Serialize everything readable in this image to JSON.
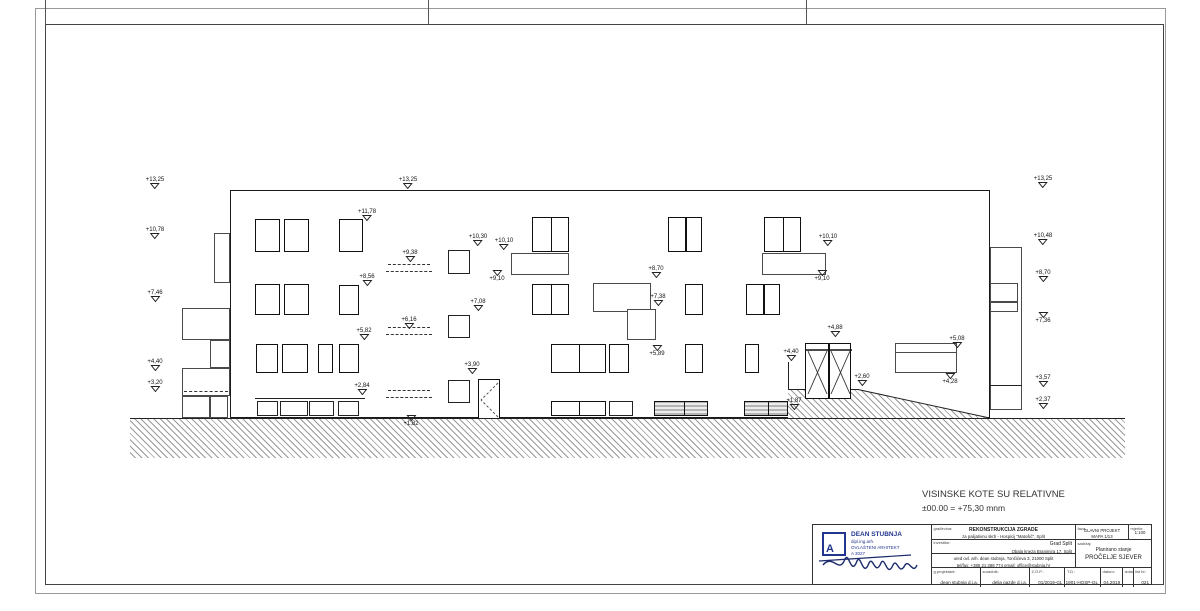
{
  "notes": {
    "line1": "VISINSKE KOTE SU RELATIVNE",
    "line2": "±00.00 = +75,30 mnm"
  },
  "drawing": {
    "elevation_markers": [
      {
        "label": "+13,25",
        "x": 155,
        "y": 190
      },
      {
        "label": "+10,78",
        "x": 155,
        "y": 240
      },
      {
        "label": "+7,46",
        "x": 155,
        "y": 303
      },
      {
        "label": "+4,40",
        "x": 155,
        "y": 372
      },
      {
        "label": "+3,20",
        "x": 155,
        "y": 393
      },
      {
        "label": "+13,25",
        "x": 408,
        "y": 190
      },
      {
        "label": "+11,78",
        "x": 367,
        "y": 222
      },
      {
        "label": "+10,30",
        "x": 478,
        "y": 247
      },
      {
        "label": "+10,10",
        "x": 504,
        "y": 251
      },
      {
        "label": "+9,38",
        "x": 410,
        "y": 263
      },
      {
        "label": "+9,10",
        "x": 497,
        "y": 271,
        "below": true
      },
      {
        "label": "+8,56",
        "x": 367,
        "y": 287
      },
      {
        "label": "+8,70",
        "x": 656,
        "y": 279
      },
      {
        "label": "+7,38",
        "x": 658,
        "y": 307
      },
      {
        "label": "+7,08",
        "x": 478,
        "y": 312
      },
      {
        "label": "+6,16",
        "x": 409,
        "y": 330
      },
      {
        "label": "+5,82",
        "x": 364,
        "y": 341
      },
      {
        "label": "+5,89",
        "x": 657,
        "y": 346,
        "below": true
      },
      {
        "label": "+3,90",
        "x": 472,
        "y": 375
      },
      {
        "label": "+2,84",
        "x": 362,
        "y": 396
      },
      {
        "label": "+1,82",
        "x": 411,
        "y": 416,
        "below": true
      },
      {
        "label": "+4,40",
        "x": 791,
        "y": 362
      },
      {
        "label": "+4,88",
        "x": 835,
        "y": 338
      },
      {
        "label": "+2,60",
        "x": 862,
        "y": 387
      },
      {
        "label": "+1,87",
        "x": 794,
        "y": 411
      },
      {
        "label": "+5,08",
        "x": 957,
        "y": 349
      },
      {
        "label": "+4,28",
        "x": 950,
        "y": 374,
        "below": true
      },
      {
        "label": "+10,10",
        "x": 828,
        "y": 247
      },
      {
        "label": "+9,10",
        "x": 822,
        "y": 271,
        "below": true
      },
      {
        "label": "+13,25",
        "x": 1043,
        "y": 189
      },
      {
        "label": "+10,48",
        "x": 1043,
        "y": 246
      },
      {
        "label": "+8,70",
        "x": 1043,
        "y": 283
      },
      {
        "label": "+7,36",
        "x": 1043,
        "y": 313,
        "below": true
      },
      {
        "label": "+3,57",
        "x": 1043,
        "y": 388
      },
      {
        "label": "+2,37",
        "x": 1043,
        "y": 410
      }
    ],
    "rects": [
      {
        "x": 255,
        "y": 219,
        "w": 25,
        "h": 33,
        "cls": "win"
      },
      {
        "x": 284,
        "y": 219,
        "w": 25,
        "h": 33,
        "cls": "win"
      },
      {
        "x": 339,
        "y": 219,
        "w": 24,
        "h": 33,
        "cls": "win"
      },
      {
        "x": 532,
        "y": 217,
        "w": 37,
        "h": 35,
        "cls": "win2"
      },
      {
        "x": 668,
        "y": 217,
        "w": 34,
        "h": 35,
        "cls": "win2"
      },
      {
        "x": 764,
        "y": 217,
        "w": 37,
        "h": 35,
        "cls": "win2"
      },
      {
        "x": 255,
        "y": 284,
        "w": 25,
        "h": 31,
        "cls": "win"
      },
      {
        "x": 284,
        "y": 284,
        "w": 25,
        "h": 31,
        "cls": "win"
      },
      {
        "x": 339,
        "y": 285,
        "w": 20,
        "h": 30,
        "cls": "win"
      },
      {
        "x": 532,
        "y": 284,
        "w": 37,
        "h": 31,
        "cls": "win2"
      },
      {
        "x": 685,
        "y": 284,
        "w": 18,
        "h": 31,
        "cls": "win"
      },
      {
        "x": 746,
        "y": 284,
        "w": 34,
        "h": 31,
        "cls": "win2"
      },
      {
        "x": 448,
        "y": 250,
        "w": 22,
        "h": 24,
        "cls": "winT"
      },
      {
        "x": 448,
        "y": 315,
        "w": 22,
        "h": 23,
        "cls": "winT"
      },
      {
        "x": 448,
        "y": 380,
        "w": 22,
        "h": 23,
        "cls": "winT"
      },
      {
        "x": 256,
        "y": 344,
        "w": 22,
        "h": 29,
        "cls": "win"
      },
      {
        "x": 282,
        "y": 344,
        "w": 26,
        "h": 29,
        "cls": "win"
      },
      {
        "x": 318,
        "y": 344,
        "w": 15,
        "h": 29,
        "cls": "win"
      },
      {
        "x": 339,
        "y": 344,
        "w": 20,
        "h": 29,
        "cls": "win"
      },
      {
        "x": 551,
        "y": 344,
        "w": 55,
        "h": 29,
        "cls": "win2"
      },
      {
        "x": 609,
        "y": 344,
        "w": 20,
        "h": 29,
        "cls": "win"
      },
      {
        "x": 685,
        "y": 344,
        "w": 18,
        "h": 29,
        "cls": "win"
      },
      {
        "x": 745,
        "y": 344,
        "w": 14,
        "h": 29,
        "cls": "win"
      },
      {
        "x": 257,
        "y": 401,
        "w": 21,
        "h": 15,
        "cls": "winT"
      },
      {
        "x": 280,
        "y": 401,
        "w": 28,
        "h": 15,
        "cls": "winT"
      },
      {
        "x": 309,
        "y": 401,
        "w": 25,
        "h": 15,
        "cls": "winT"
      },
      {
        "x": 338,
        "y": 401,
        "w": 21,
        "h": 15,
        "cls": "winT"
      },
      {
        "x": 551,
        "y": 401,
        "w": 55,
        "h": 15,
        "cls": "win2"
      },
      {
        "x": 609,
        "y": 401,
        "w": 24,
        "h": 15,
        "cls": "winT"
      },
      {
        "x": 654,
        "y": 401,
        "w": 54,
        "h": 15,
        "cls": "gray2"
      },
      {
        "x": 744,
        "y": 401,
        "w": 44,
        "h": 15,
        "cls": "gray2"
      },
      {
        "x": 511,
        "y": 253,
        "w": 58,
        "h": 22,
        "cls": "thin",
        "name": "canopy-slab"
      },
      {
        "x": 762,
        "y": 253,
        "w": 64,
        "h": 22,
        "cls": "thin",
        "name": "canopy-slab"
      },
      {
        "x": 593,
        "y": 283,
        "w": 58,
        "h": 29,
        "cls": "thin",
        "name": "recess-panel"
      },
      {
        "x": 627,
        "y": 309,
        "w": 29,
        "h": 31,
        "cls": "thin",
        "name": "recess-panel"
      },
      {
        "x": 895,
        "y": 343,
        "w": 62,
        "h": 30,
        "cls": "thin2",
        "name": "parapet-wall"
      },
      {
        "x": 214,
        "y": 233,
        "w": 16,
        "h": 50,
        "cls": "thin",
        "name": "side-volume"
      },
      {
        "x": 182,
        "y": 308,
        "w": 48,
        "h": 32,
        "cls": "thin",
        "name": "side-volume"
      },
      {
        "x": 210,
        "y": 340,
        "w": 20,
        "h": 28,
        "cls": "thin",
        "name": "side-volume"
      },
      {
        "x": 182,
        "y": 368,
        "w": 48,
        "h": 28,
        "cls": "thin",
        "name": "side-volume"
      },
      {
        "x": 182,
        "y": 396,
        "w": 28,
        "h": 22,
        "cls": "thin",
        "name": "side-volume"
      },
      {
        "x": 210,
        "y": 396,
        "w": 18,
        "h": 22,
        "cls": "thin",
        "name": "side-volume"
      },
      {
        "x": 990,
        "y": 247,
        "w": 32,
        "h": 163,
        "cls": "thin",
        "name": "side-volume"
      },
      {
        "x": 990,
        "y": 283,
        "w": 28,
        "h": 19,
        "cls": "thin",
        "name": "side-volume"
      },
      {
        "x": 990,
        "y": 302,
        "w": 28,
        "h": 10,
        "cls": "thin",
        "name": "side-volume"
      }
    ],
    "lines": [
      {
        "x": 990,
        "y": 385,
        "w": 32,
        "h": 0
      },
      {
        "x": 788,
        "y": 362,
        "w": 0,
        "h": 56
      },
      {
        "x": 255,
        "y": 398,
        "w": 110,
        "h": 0
      }
    ],
    "dashes": [
      {
        "x": 388,
        "y": 264,
        "w": 42
      },
      {
        "x": 386,
        "y": 271,
        "w": 46
      },
      {
        "x": 388,
        "y": 327,
        "w": 42
      },
      {
        "x": 386,
        "y": 334,
        "w": 46
      },
      {
        "x": 388,
        "y": 390,
        "w": 42
      },
      {
        "x": 386,
        "y": 397,
        "w": 46
      },
      {
        "x": 184,
        "y": 391,
        "w": 44
      }
    ]
  },
  "title_block": {
    "logo": {
      "name": "DEAN STUBNJA",
      "sub1": "dipl.ing.arh.",
      "sub2": "OVLAŠTENI ARHITEKT",
      "sub3": "A 3027",
      "letter": "A"
    },
    "fields": {
      "gradevina_label": "građevina:",
      "project_line1": "REKONSTRUKCIJA ZGRADE",
      "project_line2": "za palijativnu skrb - Hospicij \"Matošić\", Split",
      "investitor_label": "investitor:",
      "investor_line1": "Grad Split",
      "investor_line2": "Obala kneza Branimira 17, Split",
      "office_line1": "ured ovl. arh. dean stubnja, Tončićeva 3, 21000 Split",
      "office_line2": "tel/fax: +385 21 388 774    email: office@stubnja.hr",
      "faza_label": "faza:",
      "faza_line1": "GLAVNI PROJEKT",
      "faza_line2": "MAPA 1/13",
      "mjerilo_label": "mjerilo:",
      "mjerilo_value": "1:100",
      "sadrzaj_label": "sadržaj:",
      "sadrzaj_line1": "Planirano stanje",
      "sadrzaj_line2": "PROČELJE SJEVER",
      "row": [
        {
          "label": "g.projektant:",
          "value": "dean stubnja d.i.a.",
          "w": 50
        },
        {
          "label": "suradnik:",
          "value": "delia gazde d.i.a.",
          "w": 50
        },
        {
          "label": "Z.O.P.:",
          "value": "01/2019-GL",
          "w": 36
        },
        {
          "label": "T.D.:",
          "value": "1901-HOSP-GL",
          "w": 36
        },
        {
          "label": "datum:",
          "value": "04.2019",
          "w": 22
        },
        {
          "label": "izdao:",
          "value": "",
          "w": 10
        },
        {
          "label": "list br:",
          "value": "021",
          "w": 18
        }
      ]
    },
    "accent_color": "#23368f"
  }
}
